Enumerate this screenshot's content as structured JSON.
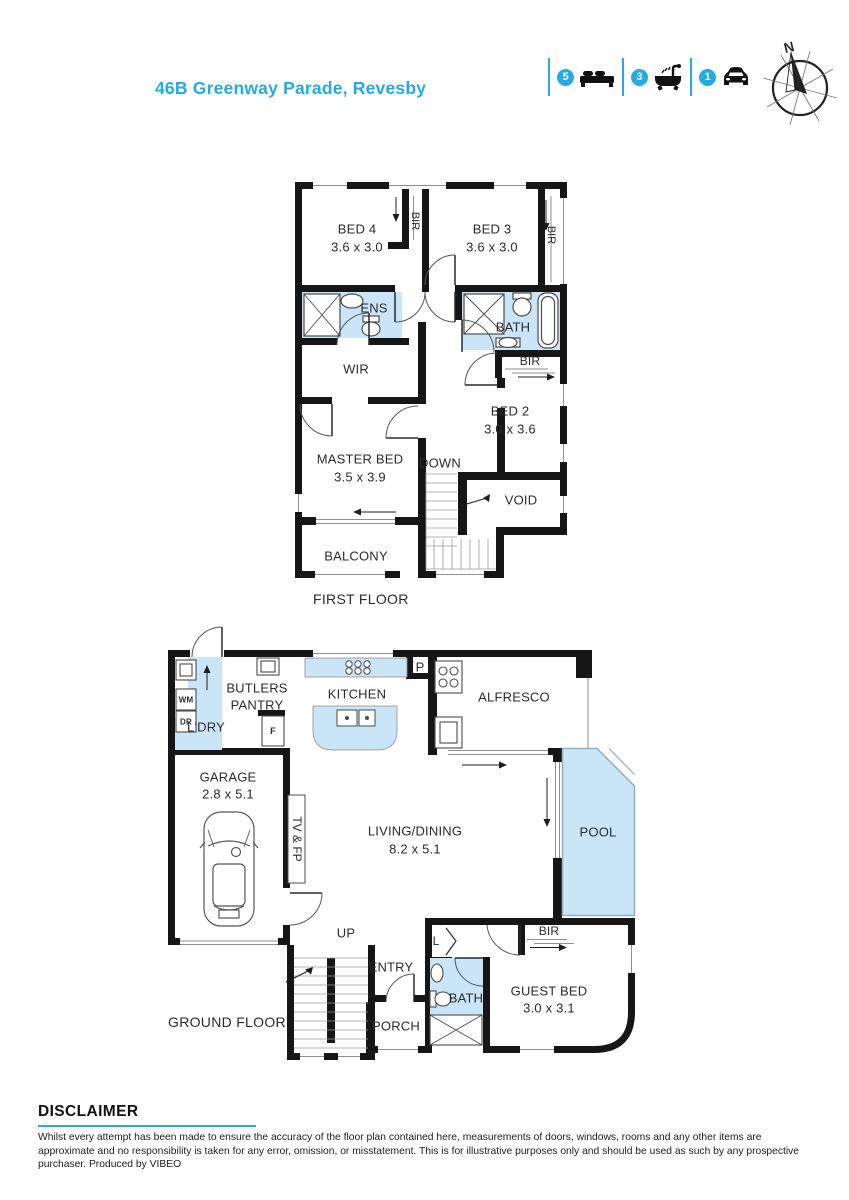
{
  "header": {
    "title": "46B Greenway Parade, Revesby",
    "stats": [
      {
        "count": "5",
        "icon": "bed-icon"
      },
      {
        "count": "3",
        "icon": "bath-icon"
      },
      {
        "count": "1",
        "icon": "car-icon"
      }
    ],
    "compass_label": "N"
  },
  "ff": {
    "floor_label": "FIRST FLOOR",
    "bed4": "BED 4",
    "bed4_dims": "3.6 x 3.0",
    "bir1": "BIR",
    "bed3": "BED 3",
    "bed3_dims": "3.6 x 3.0",
    "bir2": "BIR",
    "ens": "ENS",
    "bath": "BATH",
    "wir": "WIR",
    "bir3": "BIR",
    "bed2": "BED 2",
    "bed2_dims": "3.0 x 3.6",
    "master": "MASTER BED",
    "master_dims": "3.5 x 3.9",
    "down": "DOWN",
    "void": "VOID",
    "balcony": "BALCONY"
  },
  "gf": {
    "floor_label": "GROUND FLOOR",
    "butlers1": "BUTLERS",
    "butlers2": "PANTRY",
    "ldry": "L'DRY",
    "wm": "WM",
    "dr": "DR",
    "f": "F",
    "p": "P",
    "kitchen": "KITCHEN",
    "alfresco": "ALFRESCO",
    "garage": "GARAGE",
    "garage_dims": "2.8 x 5.1",
    "tvfp": "TV & FP",
    "living": "LIVING/DINING",
    "living_dims": "8.2 x 5.1",
    "pool": "POOL",
    "up": "UP",
    "entry": "ENTRY",
    "porch": "PORCH",
    "l": "L",
    "bath": "BATH",
    "guest": "GUEST BED",
    "guest_dims": "3.0 x 3.1",
    "bir": "BIR"
  },
  "disclaimer": {
    "heading": "DISCLAIMER",
    "body": "Whilst every attempt  has been made to ensure the accuracy of the floor plan contained here, measurements of doors, windows, rooms and any other items are approximate and no responsibility is taken for any error, omission, or misstatement. This is for illustrative purposes only and should be used as such by any prospective purchaser. Produced by VIBEO"
  },
  "colors": {
    "accent": "#29a9e2",
    "wet_area": "#c9e5f7",
    "wall": "#161616",
    "pool_border": "#96aebf"
  }
}
